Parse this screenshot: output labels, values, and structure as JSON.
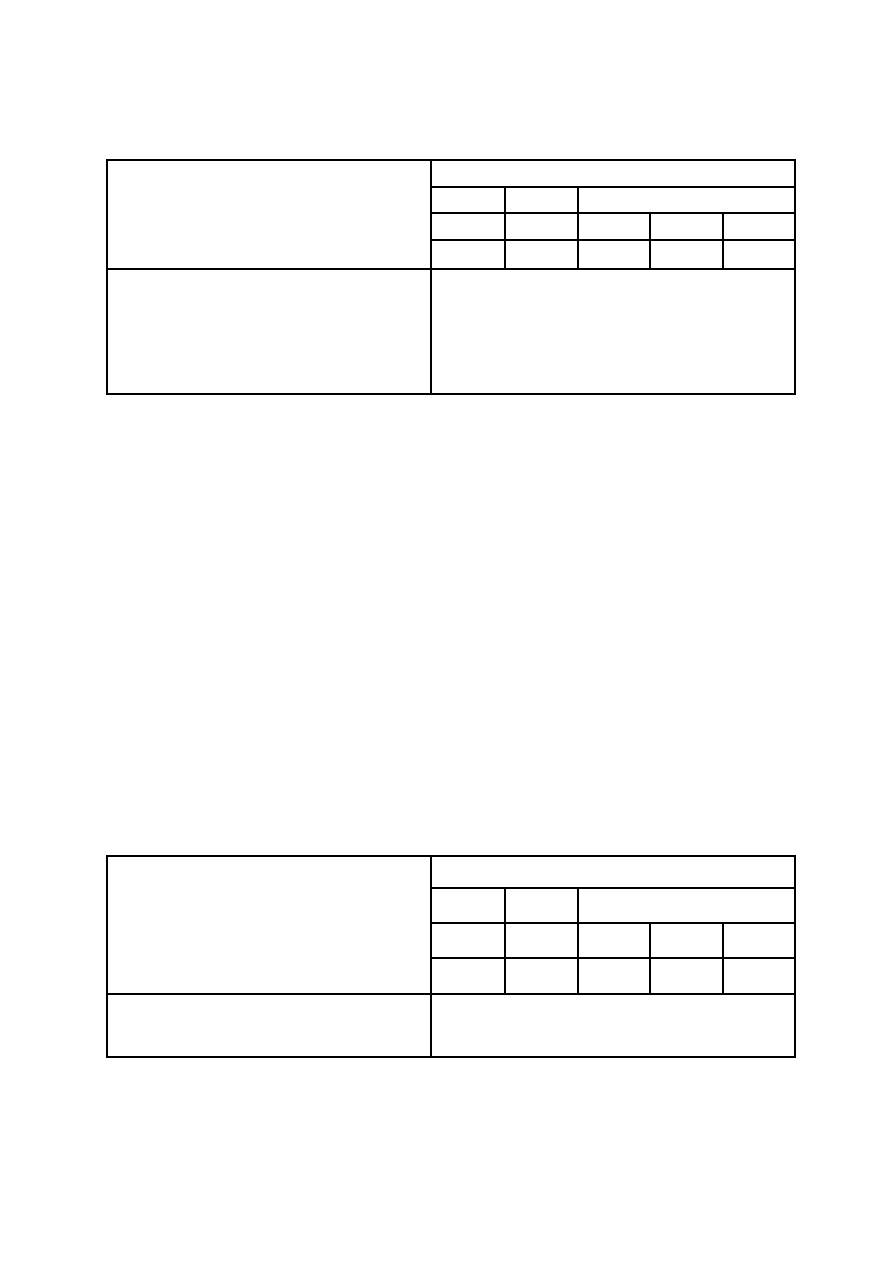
{
  "page": {
    "background_color": "#ffffff",
    "table_border_color": "#000000",
    "visible_text": ""
  },
  "upper_table": {
    "row_count": 5,
    "column_count": 6,
    "rows": [
      {
        "cells": [
          "",
          ""
        ]
      },
      {
        "cells": [
          "",
          "",
          ""
        ]
      },
      {
        "cells": [
          "",
          "",
          "",
          "",
          ""
        ]
      },
      {
        "cells": [
          "",
          "",
          "",
          "",
          ""
        ]
      },
      {
        "cells": [
          "",
          ""
        ]
      }
    ]
  },
  "lower_table": {
    "row_count": 5,
    "column_count": 6,
    "rows": [
      {
        "cells": [
          "",
          ""
        ]
      },
      {
        "cells": [
          "",
          "",
          ""
        ]
      },
      {
        "cells": [
          "",
          "",
          "",
          "",
          ""
        ]
      },
      {
        "cells": [
          "",
          "",
          "",
          "",
          ""
        ]
      },
      {
        "cells": [
          "",
          ""
        ]
      }
    ]
  }
}
